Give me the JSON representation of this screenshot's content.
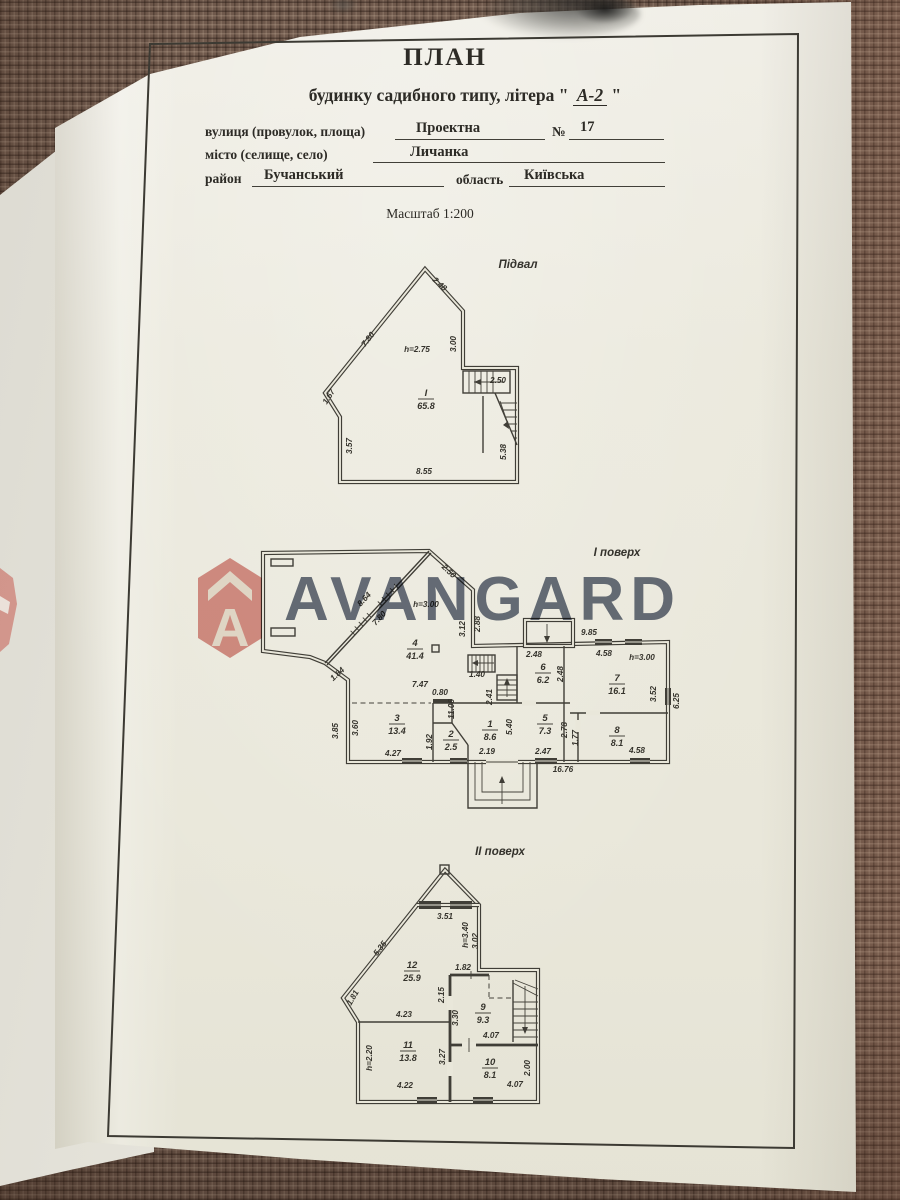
{
  "header": {
    "title": "ПЛАН",
    "subtitle_prefix": "будинку садибного типу, літера \"",
    "subtitle_value": "А-2",
    "subtitle_suffix": "\"",
    "street_label": "вулиця (провулок, площа)",
    "street_value": "Проектна",
    "number_label": "№",
    "number_value": "17",
    "city_label": "місто (селище, село)",
    "city_value": "Личанка",
    "district_label": "район",
    "district_value": "Бучанський",
    "region_label": "область",
    "region_value": "Київська",
    "scale": "Масштаб 1:200"
  },
  "watermark": {
    "brand": "AVANGARD",
    "icon": "avangard-house-logo",
    "accent_red": "#c2453e",
    "text_color": "#49546a"
  },
  "plans": [
    {
      "id": "basement",
      "title": "Підвал",
      "tx": 220,
      "ty": 15,
      "rooms": [
        {
          "num": "I",
          "area": "65.8",
          "x": 128,
          "y": 143
        }
      ],
      "dims": [
        {
          "t": "2.48",
          "x": 140,
          "y": 33,
          "r": 42
        },
        {
          "t": "7.80",
          "x": 72,
          "y": 88,
          "r": -52
        },
        {
          "t": "3.00",
          "x": 158,
          "y": 91,
          "r": -90
        },
        {
          "t": "h=2.75",
          "x": 119,
          "y": 99
        },
        {
          "t": "2.50",
          "x": 200,
          "y": 130
        },
        {
          "t": "1.67",
          "x": 33,
          "y": 145,
          "r": -58
        },
        {
          "t": "3.57",
          "x": 54,
          "y": 193,
          "r": -90
        },
        {
          "t": "8.55",
          "x": 126,
          "y": 221
        },
        {
          "t": "5.38",
          "x": 208,
          "y": 199,
          "r": -90
        }
      ]
    },
    {
      "id": "floor1",
      "title": "І поверх",
      "tx": 361,
      "ty": 10,
      "rooms": [
        {
          "num": "4",
          "area": "41.4",
          "x": 159,
          "y": 100
        },
        {
          "num": "3",
          "area": "13.4",
          "x": 141,
          "y": 175
        },
        {
          "num": "2",
          "area": "2.5",
          "x": 195,
          "y": 191
        },
        {
          "num": "1",
          "area": "8.6",
          "x": 234,
          "y": 181
        },
        {
          "num": "5",
          "area": "7.3",
          "x": 289,
          "y": 175
        },
        {
          "num": "6",
          "area": "6.2",
          "x": 287,
          "y": 124
        },
        {
          "num": "7",
          "area": "16.1",
          "x": 361,
          "y": 135
        },
        {
          "num": "8",
          "area": "8.1",
          "x": 361,
          "y": 187
        }
      ],
      "dims": [
        {
          "t": "2.50",
          "x": 191,
          "y": 27,
          "r": 44
        },
        {
          "t": "8.64",
          "x": 110,
          "y": 55,
          "r": -47
        },
        {
          "t": "7.80",
          "x": 125,
          "y": 74,
          "r": -47
        },
        {
          "t": "h=3.00",
          "x": 170,
          "y": 61
        },
        {
          "t": "3.12",
          "x": 209,
          "y": 83,
          "r": -90
        },
        {
          "t": "2.88",
          "x": 224,
          "y": 78,
          "r": -90
        },
        {
          "t": "9.85",
          "x": 333,
          "y": 89
        },
        {
          "t": "2.48",
          "x": 278,
          "y": 111
        },
        {
          "t": "4.58",
          "x": 348,
          "y": 110
        },
        {
          "t": "h=3.00",
          "x": 386,
          "y": 114
        },
        {
          "t": "1.40",
          "x": 221,
          "y": 131
        },
        {
          "t": "2.41",
          "x": 236,
          "y": 151,
          "r": -90
        },
        {
          "t": "2.48",
          "x": 307,
          "y": 128,
          "r": -90
        },
        {
          "t": "3.52",
          "x": 400,
          "y": 148,
          "r": -90
        },
        {
          "t": "6.25",
          "x": 423,
          "y": 155,
          "r": -90
        },
        {
          "t": "1.84",
          "x": 83,
          "y": 130,
          "r": -42
        },
        {
          "t": "7.47",
          "x": 164,
          "y": 141
        },
        {
          "t": "0.80",
          "x": 184,
          "y": 149
        },
        {
          "t": "11.06",
          "x": 198,
          "y": 163,
          "r": -90
        },
        {
          "t": "3.85",
          "x": 82,
          "y": 185,
          "r": -90
        },
        {
          "t": "3.60",
          "x": 102,
          "y": 182,
          "r": -90
        },
        {
          "t": "1.92",
          "x": 176,
          "y": 196,
          "r": -90
        },
        {
          "t": "2.19",
          "x": 231,
          "y": 208
        },
        {
          "t": "5.40",
          "x": 256,
          "y": 181,
          "r": -90
        },
        {
          "t": "2.47",
          "x": 287,
          "y": 208
        },
        {
          "t": "2.78",
          "x": 311,
          "y": 184,
          "r": -90
        },
        {
          "t": "1.77",
          "x": 322,
          "y": 192,
          "r": -90
        },
        {
          "t": "4.58",
          "x": 381,
          "y": 207
        },
        {
          "t": "4.27",
          "x": 137,
          "y": 210
        },
        {
          "t": "16.76",
          "x": 307,
          "y": 226
        }
      ]
    },
    {
      "id": "floor2",
      "title": "ІІ поверх",
      "tx": 174,
      "ty": 9,
      "rooms": [
        {
          "num": "12",
          "area": "25.9",
          "x": 86,
          "y": 122
        },
        {
          "num": "9",
          "area": "9.3",
          "x": 157,
          "y": 164
        },
        {
          "num": "11",
          "area": "13.8",
          "x": 82,
          "y": 202
        },
        {
          "num": "10",
          "area": "8.1",
          "x": 164,
          "y": 219
        }
      ],
      "dims": [
        {
          "t": "3.51",
          "x": 119,
          "y": 73
        },
        {
          "t": "h=3.40",
          "x": 142,
          "y": 89,
          "r": -90
        },
        {
          "t": "3.02",
          "x": 152,
          "y": 95,
          "r": -90
        },
        {
          "t": "5.35",
          "x": 56,
          "y": 104,
          "r": -52
        },
        {
          "t": "1.81",
          "x": 29,
          "y": 153,
          "r": -60
        },
        {
          "t": "1.82",
          "x": 137,
          "y": 124
        },
        {
          "t": "2.15",
          "x": 118,
          "y": 149,
          "r": -90
        },
        {
          "t": "3.30",
          "x": 132,
          "y": 172,
          "r": -90
        },
        {
          "t": "4.23",
          "x": 78,
          "y": 171
        },
        {
          "t": "4.07",
          "x": 165,
          "y": 192
        },
        {
          "t": "3.27",
          "x": 119,
          "y": 211,
          "r": -90
        },
        {
          "t": "h=2.20",
          "x": 46,
          "y": 212,
          "r": -90
        },
        {
          "t": "2.00",
          "x": 204,
          "y": 222,
          "r": -90
        },
        {
          "t": "4.22",
          "x": 79,
          "y": 242
        },
        {
          "t": "4.07",
          "x": 189,
          "y": 241
        }
      ]
    }
  ]
}
